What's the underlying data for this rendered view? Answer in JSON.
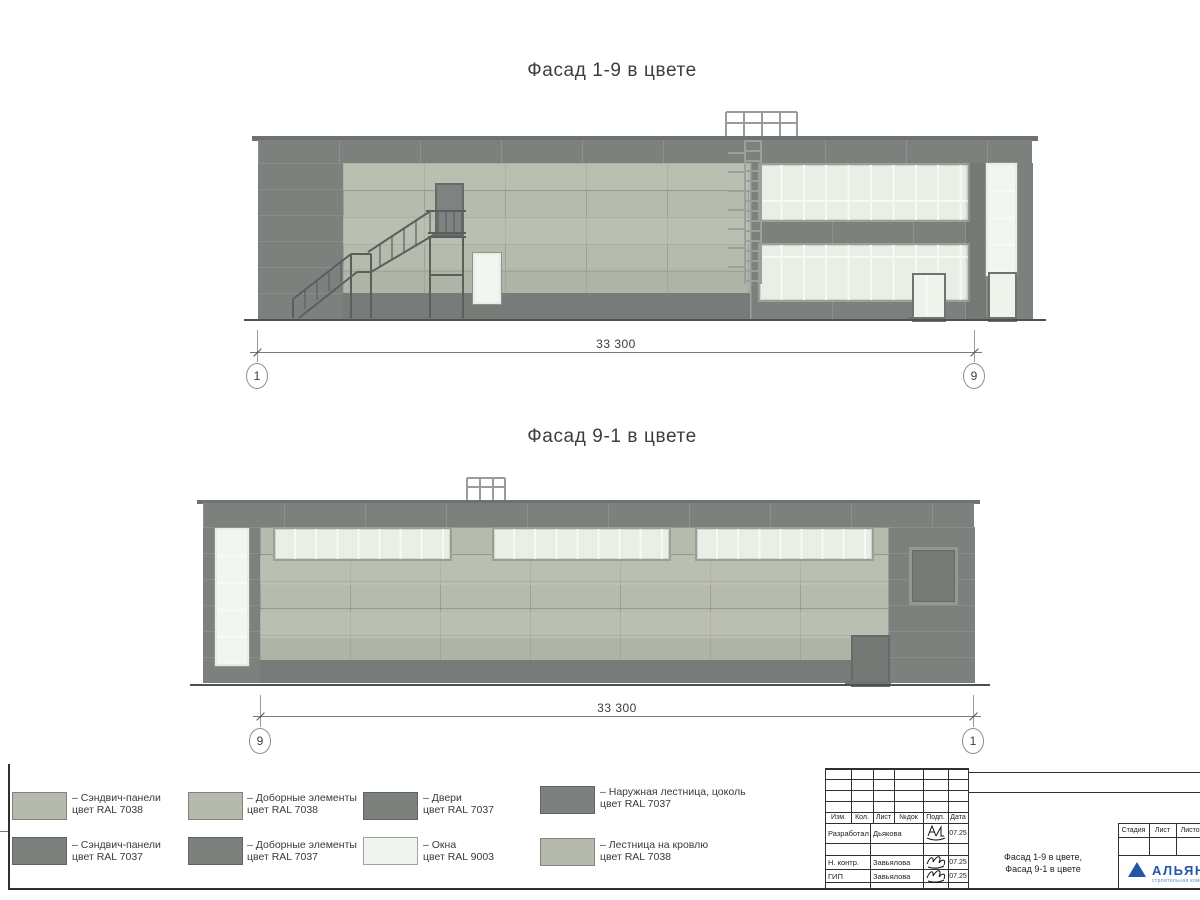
{
  "facade1": {
    "title": "Фасад 1-9 в цвете",
    "dimension_label": "33 300",
    "grid_left": "1",
    "grid_right": "9"
  },
  "facade2": {
    "title": "Фасад 9-1 в цвете",
    "dimension_label": "33 300",
    "grid_left": "9",
    "grid_right": "1"
  },
  "colors": {
    "panel_light_ral7038": "#b6baad",
    "panel_dark_ral7037": "#7d817e",
    "window_ral9003": "#f0f4ee",
    "logo_blue": "#2257a8"
  },
  "legend": {
    "items": [
      {
        "line1": "– Сэндвич-панели",
        "line2": "цвет RAL 7038",
        "swatch": "#b6baad"
      },
      {
        "line1": "– Сэндвич-панели",
        "line2": "цвет RAL 7037",
        "swatch": "#7d817e"
      },
      {
        "line1": "– Доборные элементы",
        "line2": "цвет RAL 7038",
        "swatch": "#b6baad"
      },
      {
        "line1": "– Доборные элементы",
        "line2": "цвет RAL 7037",
        "swatch": "#7d817e"
      },
      {
        "line1": "– Двери",
        "line2": "цвет RAL 7037",
        "swatch": "#7d817e"
      },
      {
        "line1": "– Окна",
        "line2": "цвет RAL 9003",
        "swatch": "#f0f4ee"
      },
      {
        "line1": "– Наружная лестница, цоколь",
        "line2": "цвет RAL 7037",
        "swatch": "#7d817e"
      },
      {
        "line1": "– Лестница на кровлю",
        "line2": "цвет RAL 7038",
        "swatch": "#b6baad"
      }
    ]
  },
  "title_block": {
    "rev_headers": [
      "Изм.",
      "Кол.",
      "Лист",
      "№док",
      "Подп.",
      "Дата"
    ],
    "signers": [
      {
        "role": "Разработал",
        "name": "Дьякова",
        "date": "07.25"
      },
      {
        "role": "Н. контр.",
        "name": "Завьялова",
        "date": "07.25"
      },
      {
        "role": "ГИП",
        "name": "Завьялова",
        "date": "07.25"
      }
    ],
    "doc_title_line1": "Фасад 1-9 в цвете,",
    "doc_title_line2": "Фасад 9-1 в цвете",
    "stage_header": "Стадия",
    "sheet_header": "Лист",
    "sheets_header": "Листов",
    "logo_text": "АЛЬЯНС",
    "logo_subtext": "строительная компания"
  }
}
